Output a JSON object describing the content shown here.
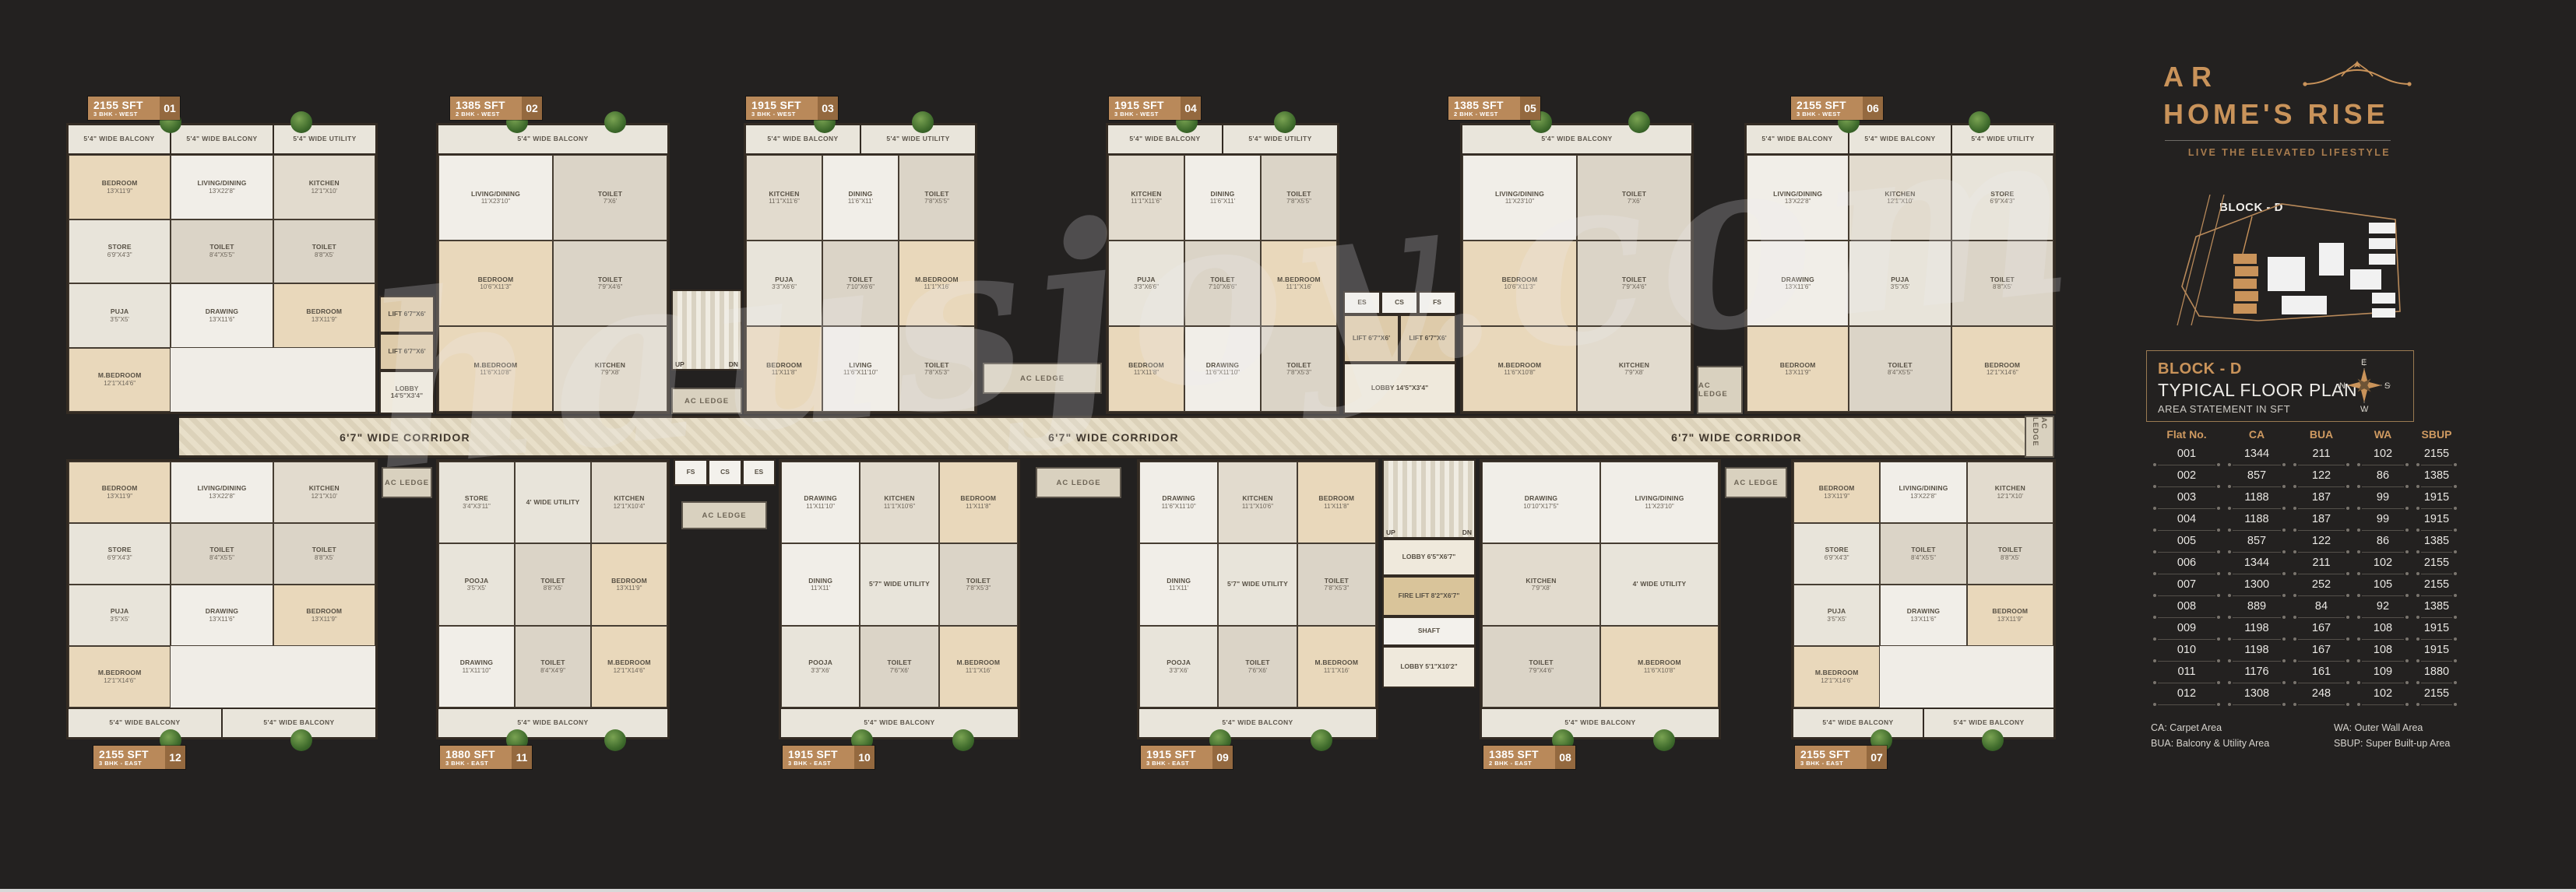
{
  "watermark": "hausjoy.com",
  "corridor": {
    "label": "6'7\" WIDE CORRIDOR"
  },
  "common": {
    "ac_ledge": "AC LEDGE",
    "up": "UP",
    "dn": "DN",
    "lobby_main": "LOBBY 14'5\"X3'4\"",
    "lift": "LIFT 6'7\"X6'",
    "es": "ES",
    "cs": "CS",
    "fs": "FS",
    "fire_lift": "FIRE LIFT 8'2\"X6'7\"",
    "shaft": "SHAFT",
    "lobby_small": "LOBBY 6'5\"X6'7\"",
    "lobby_stair": "LOBBY 5'1\"X10'2\""
  },
  "units": [
    {
      "id": "01",
      "area": "2155 SFT",
      "bhk": "3 BHK - WEST",
      "row": "top",
      "balcony": [
        "5'4\" WIDE BALCONY",
        "5'4\" WIDE BALCONY",
        "5'4\" WIDE UTILITY"
      ],
      "rooms": [
        "BEDROOM 13'X11'9\"",
        "LIVING/DINING 13'X22'8\"",
        "KITCHEN 12'1\"X10'",
        "STORE 6'9\"X4'3\"",
        "TOILET 8'4\"X5'5\"",
        "TOILET 8'8\"X5'",
        "PUJA 3'5\"X5'",
        "DRAWING 13'X11'6\"",
        "BEDROOM 13'X11'9\"",
        "M.BEDROOM 12'1\"X14'6\""
      ]
    },
    {
      "id": "02",
      "area": "1385 SFT",
      "bhk": "2 BHK - WEST",
      "row": "top",
      "balcony": [
        "5'4\" WIDE BALCONY"
      ],
      "rooms": [
        "LIVING/DINING 11'X23'10\"",
        "TOILET 7'X6'",
        "BEDROOM 10'6\"X11'3\"",
        "TOILET 7'9\"X4'6\"",
        "M.BEDROOM 11'6\"X10'8\"",
        "KITCHEN 7'9\"X8'"
      ]
    },
    {
      "id": "03",
      "area": "1915 SFT",
      "bhk": "3 BHK - WEST",
      "row": "top",
      "balcony": [
        "5'4\" WIDE BALCONY",
        "5'4\" WIDE UTILITY"
      ],
      "rooms": [
        "KITCHEN 11'1\"X11'6\"",
        "DINING 11'6\"X11'",
        "TOILET 7'8\"X5'5\"",
        "PUJA 3'3\"X6'6\"",
        "TOILET 7'10\"X6'6\"",
        "M.BEDROOM 11'1\"X16'",
        "BEDROOM 11'X11'8\"",
        "LIVING 11'6\"X11'10\"",
        "TOILET 7'8\"X5'3\""
      ]
    },
    {
      "id": "04",
      "area": "1915 SFT",
      "bhk": "3 BHK - WEST",
      "row": "top",
      "balcony": [
        "5'4\" WIDE BALCONY",
        "5'4\" WIDE UTILITY"
      ],
      "rooms": [
        "KITCHEN 11'1\"X11'6\"",
        "DINING 11'6\"X11'",
        "TOILET 7'8\"X5'5\"",
        "PUJA 3'3\"X6'6\"",
        "TOILET 7'10\"X6'6\"",
        "M.BEDROOM 11'1\"X16'",
        "BEDROOM 11'X11'8\"",
        "DRAWING 11'6\"X11'10\"",
        "TOILET 7'8\"X5'3\""
      ]
    },
    {
      "id": "05",
      "area": "1385 SFT",
      "bhk": "2 BHK - WEST",
      "row": "top",
      "balcony": [
        "5'4\" WIDE BALCONY"
      ],
      "rooms": [
        "LIVING/DINING 11'X23'10\"",
        "TOILET 7'X6'",
        "BEDROOM 10'6\"X11'3\"",
        "TOILET 7'9\"X4'6\"",
        "M.BEDROOM 11'6\"X10'8\"",
        "KITCHEN 7'9\"X8'"
      ]
    },
    {
      "id": "06",
      "area": "2155 SFT",
      "bhk": "3 BHK - WEST",
      "row": "top",
      "balcony": [
        "5'4\" WIDE BALCONY",
        "5'4\" WIDE BALCONY",
        "5'4\" WIDE UTILITY"
      ],
      "rooms": [
        "LIVING/DINING 13'X22'8\"",
        "KITCHEN 12'1\"X10'",
        "STORE 6'9\"X4'3\"",
        "DRAWING 13'X11'6\"",
        "PUJA 3'5\"X5'",
        "TOILET 8'8\"X5'",
        "BEDROOM 13'X11'9\"",
        "TOILET 8'4\"X5'5\"",
        "BEDROOM 12'1\"X14'6\""
      ]
    },
    {
      "id": "07",
      "area": "2155 SFT",
      "bhk": "3 BHK - EAST",
      "row": "bottom",
      "balcony": [
        "5'4\" WIDE BALCONY",
        "5'4\" WIDE BALCONY"
      ],
      "rooms": [
        "BEDROOM 13'X11'9\"",
        "LIVING/DINING 13'X22'8\"",
        "KITCHEN 12'1\"X10'",
        "STORE 6'9\"X4'3\"",
        "TOILET 8'4\"X5'5\"",
        "TOILET 8'8\"X5'",
        "PUJA 3'5\"X5'",
        "DRAWING 13'X11'6\"",
        "BEDROOM 13'X11'9\"",
        "M.BEDROOM 12'1\"X14'6\""
      ]
    },
    {
      "id": "08",
      "area": "1385 SFT",
      "bhk": "2 BHK - EAST",
      "row": "bottom",
      "balcony": [
        "5'4\" WIDE BALCONY"
      ],
      "rooms": [
        "DRAWING 10'10\"X17'5\"",
        "LIVING/DINING 11'X23'10\"",
        "KITCHEN 7'9\"X8'",
        "4' WIDE UTILITY",
        "TOILET 7'9\"X4'6\"",
        "M.BEDROOM 11'6\"X10'8\""
      ]
    },
    {
      "id": "09",
      "area": "1915 SFT",
      "bhk": "3 BHK - EAST",
      "row": "bottom",
      "balcony": [
        "5'4\" WIDE BALCONY"
      ],
      "rooms": [
        "DRAWING 11'6\"X11'10\"",
        "KITCHEN 11'1\"X10'6\"",
        "BEDROOM 11'X11'8\"",
        "DINING 11'X11'",
        "5'7\" WIDE UTILITY",
        "TOILET 7'8\"X5'3\"",
        "POOJA 3'3\"X6'",
        "TOILET 7'6\"X6'",
        "M.BEDROOM 11'1\"X16'"
      ]
    },
    {
      "id": "10",
      "area": "1915 SFT",
      "bhk": "3 BHK - EAST",
      "row": "bottom",
      "balcony": [
        "5'4\" WIDE BALCONY"
      ],
      "rooms": [
        "DRAWING 11'X11'10\"",
        "KITCHEN 11'1\"X10'6\"",
        "BEDROOM 11'X11'8\"",
        "DINING 11'X11'",
        "5'7\" WIDE UTILITY",
        "TOILET 7'8\"X5'3\"",
        "POOJA 3'3\"X6'",
        "TOILET 7'6\"X6'",
        "M.BEDROOM 11'1\"X16'"
      ]
    },
    {
      "id": "11",
      "area": "1880 SFT",
      "bhk": "3 BHK - EAST",
      "row": "bottom",
      "balcony": [
        "5'4\" WIDE BALCONY"
      ],
      "rooms": [
        "STORE 3'4\"X3'11\"",
        "4' WIDE UTILITY",
        "KITCHEN 12'1\"X10'4\"",
        "POOJA 3'5\"X5'",
        "TOILET 8'8\"X5'",
        "BEDROOM 13'X11'9\"",
        "DRAWING 11'X11'10\"",
        "TOILET 8'4\"X4'9\"",
        "M.BEDROOM 12'1\"X14'6\""
      ]
    },
    {
      "id": "12",
      "area": "2155 SFT",
      "bhk": "3 BHK - EAST",
      "row": "bottom",
      "balcony": [
        "5'4\" WIDE BALCONY",
        "5'4\" WIDE BALCONY"
      ],
      "rooms": [
        "BEDROOM 13'X11'9\"",
        "LIVING/DINING 13'X22'8\"",
        "KITCHEN 12'1\"X10'",
        "STORE 6'9\"X4'3\"",
        "TOILET 8'4\"X5'5\"",
        "TOILET 8'8\"X5'",
        "PUJA 3'5\"X5'",
        "DRAWING 13'X11'6\"",
        "BEDROOM 13'X11'9\"",
        "M.BEDROOM 12'1\"X14'6\""
      ]
    }
  ],
  "panel": {
    "brand": {
      "line1": "AR",
      "line2": "HOME'S RISE",
      "tagline": "LIVE THE ELEVATED LIFESTYLE"
    },
    "site_map": {
      "label": "BLOCK - D"
    },
    "header": {
      "block": "BLOCK - D",
      "title": "TYPICAL FLOOR PLAN",
      "subtitle": "AREA STATEMENT IN SFT"
    },
    "compass": {
      "n": "N",
      "e": "E",
      "s": "S",
      "w": "W"
    },
    "table": {
      "columns": [
        "Flat No.",
        "CA",
        "BUA",
        "WA",
        "SBUP"
      ],
      "rows": [
        [
          "001",
          "1344",
          "211",
          "102",
          "2155"
        ],
        [
          "002",
          "857",
          "122",
          "86",
          "1385"
        ],
        [
          "003",
          "1188",
          "187",
          "99",
          "1915"
        ],
        [
          "004",
          "1188",
          "187",
          "99",
          "1915"
        ],
        [
          "005",
          "857",
          "122",
          "86",
          "1385"
        ],
        [
          "006",
          "1344",
          "211",
          "102",
          "2155"
        ],
        [
          "007",
          "1300",
          "252",
          "105",
          "2155"
        ],
        [
          "008",
          "889",
          "84",
          "92",
          "1385"
        ],
        [
          "009",
          "1198",
          "167",
          "108",
          "1915"
        ],
        [
          "010",
          "1198",
          "167",
          "108",
          "1915"
        ],
        [
          "011",
          "1176",
          "161",
          "109",
          "1880"
        ],
        [
          "012",
          "1308",
          "248",
          "102",
          "2155"
        ]
      ]
    },
    "legend": {
      "left": [
        "CA: Carpet Area",
        "BUA: Balcony & Utility Area"
      ],
      "right": [
        "WA: Outer Wall Area",
        "SBUP: Super Built-up Area"
      ]
    }
  }
}
